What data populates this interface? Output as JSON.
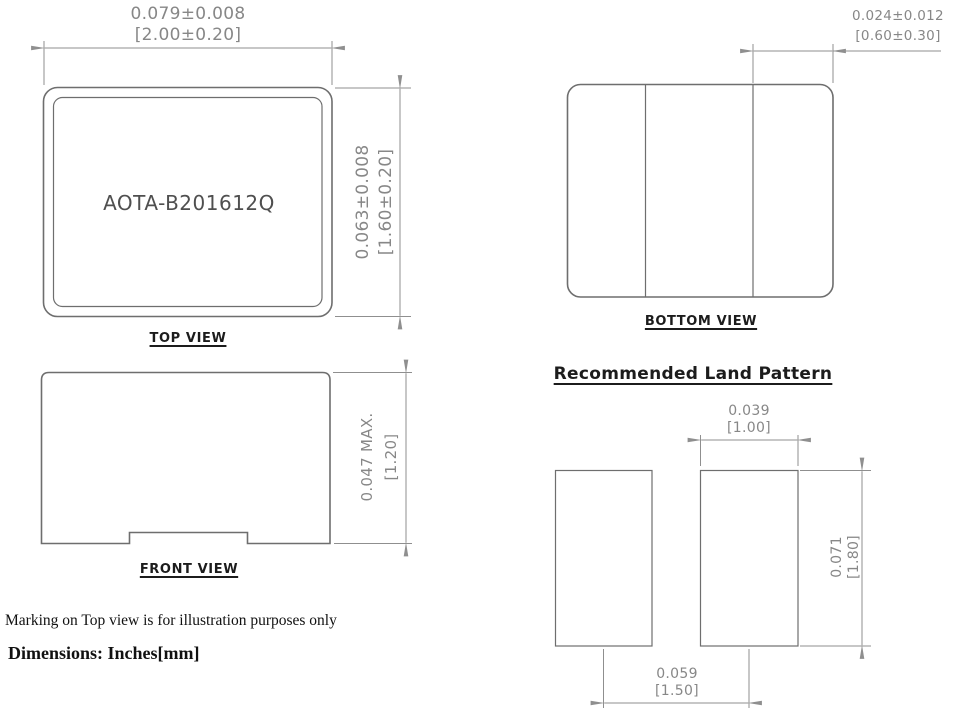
{
  "document": {
    "type": "package-outline-drawing",
    "background": "#ffffff"
  },
  "colors": {
    "dimension_text": "#878787",
    "dimension_lines": "#8f8f8f",
    "part_outline": "#6e6e6e",
    "label_text": "#1c1c1c",
    "part_marking_text": "#4f4f4f",
    "note_text": "#111111"
  },
  "top_view": {
    "label": "TOP VIEW",
    "part_marking": "AOTA-B201612Q",
    "width_dim": {
      "inches": "0.079±0.008",
      "mm": "[2.00±0.20]"
    },
    "height_dim": {
      "inches": "0.063±0.008",
      "mm": "[1.60±0.20]"
    }
  },
  "bottom_view": {
    "label": "BOTTOM VIEW",
    "terminal_dim": {
      "inches": "0.024±0.012",
      "mm": "[0.60±0.30]"
    }
  },
  "front_view": {
    "label": "FRONT VIEW",
    "height_dim": {
      "inches": "0.047  MAX.",
      "mm": "[1.20]"
    }
  },
  "land_pattern": {
    "title": "Recommended Land Pattern",
    "pad_width_dim": {
      "inches": "0.039",
      "mm": "[1.00]"
    },
    "pad_height_dim": {
      "inches": "0.071",
      "mm": "[1.80]"
    },
    "pad_pitch_dim": {
      "inches": "0.059",
      "mm": "[1.50]"
    }
  },
  "notes": {
    "marking_note": "Marking on Top view is for illustration purposes only",
    "units_note": "Dimensions: Inches[mm]"
  }
}
